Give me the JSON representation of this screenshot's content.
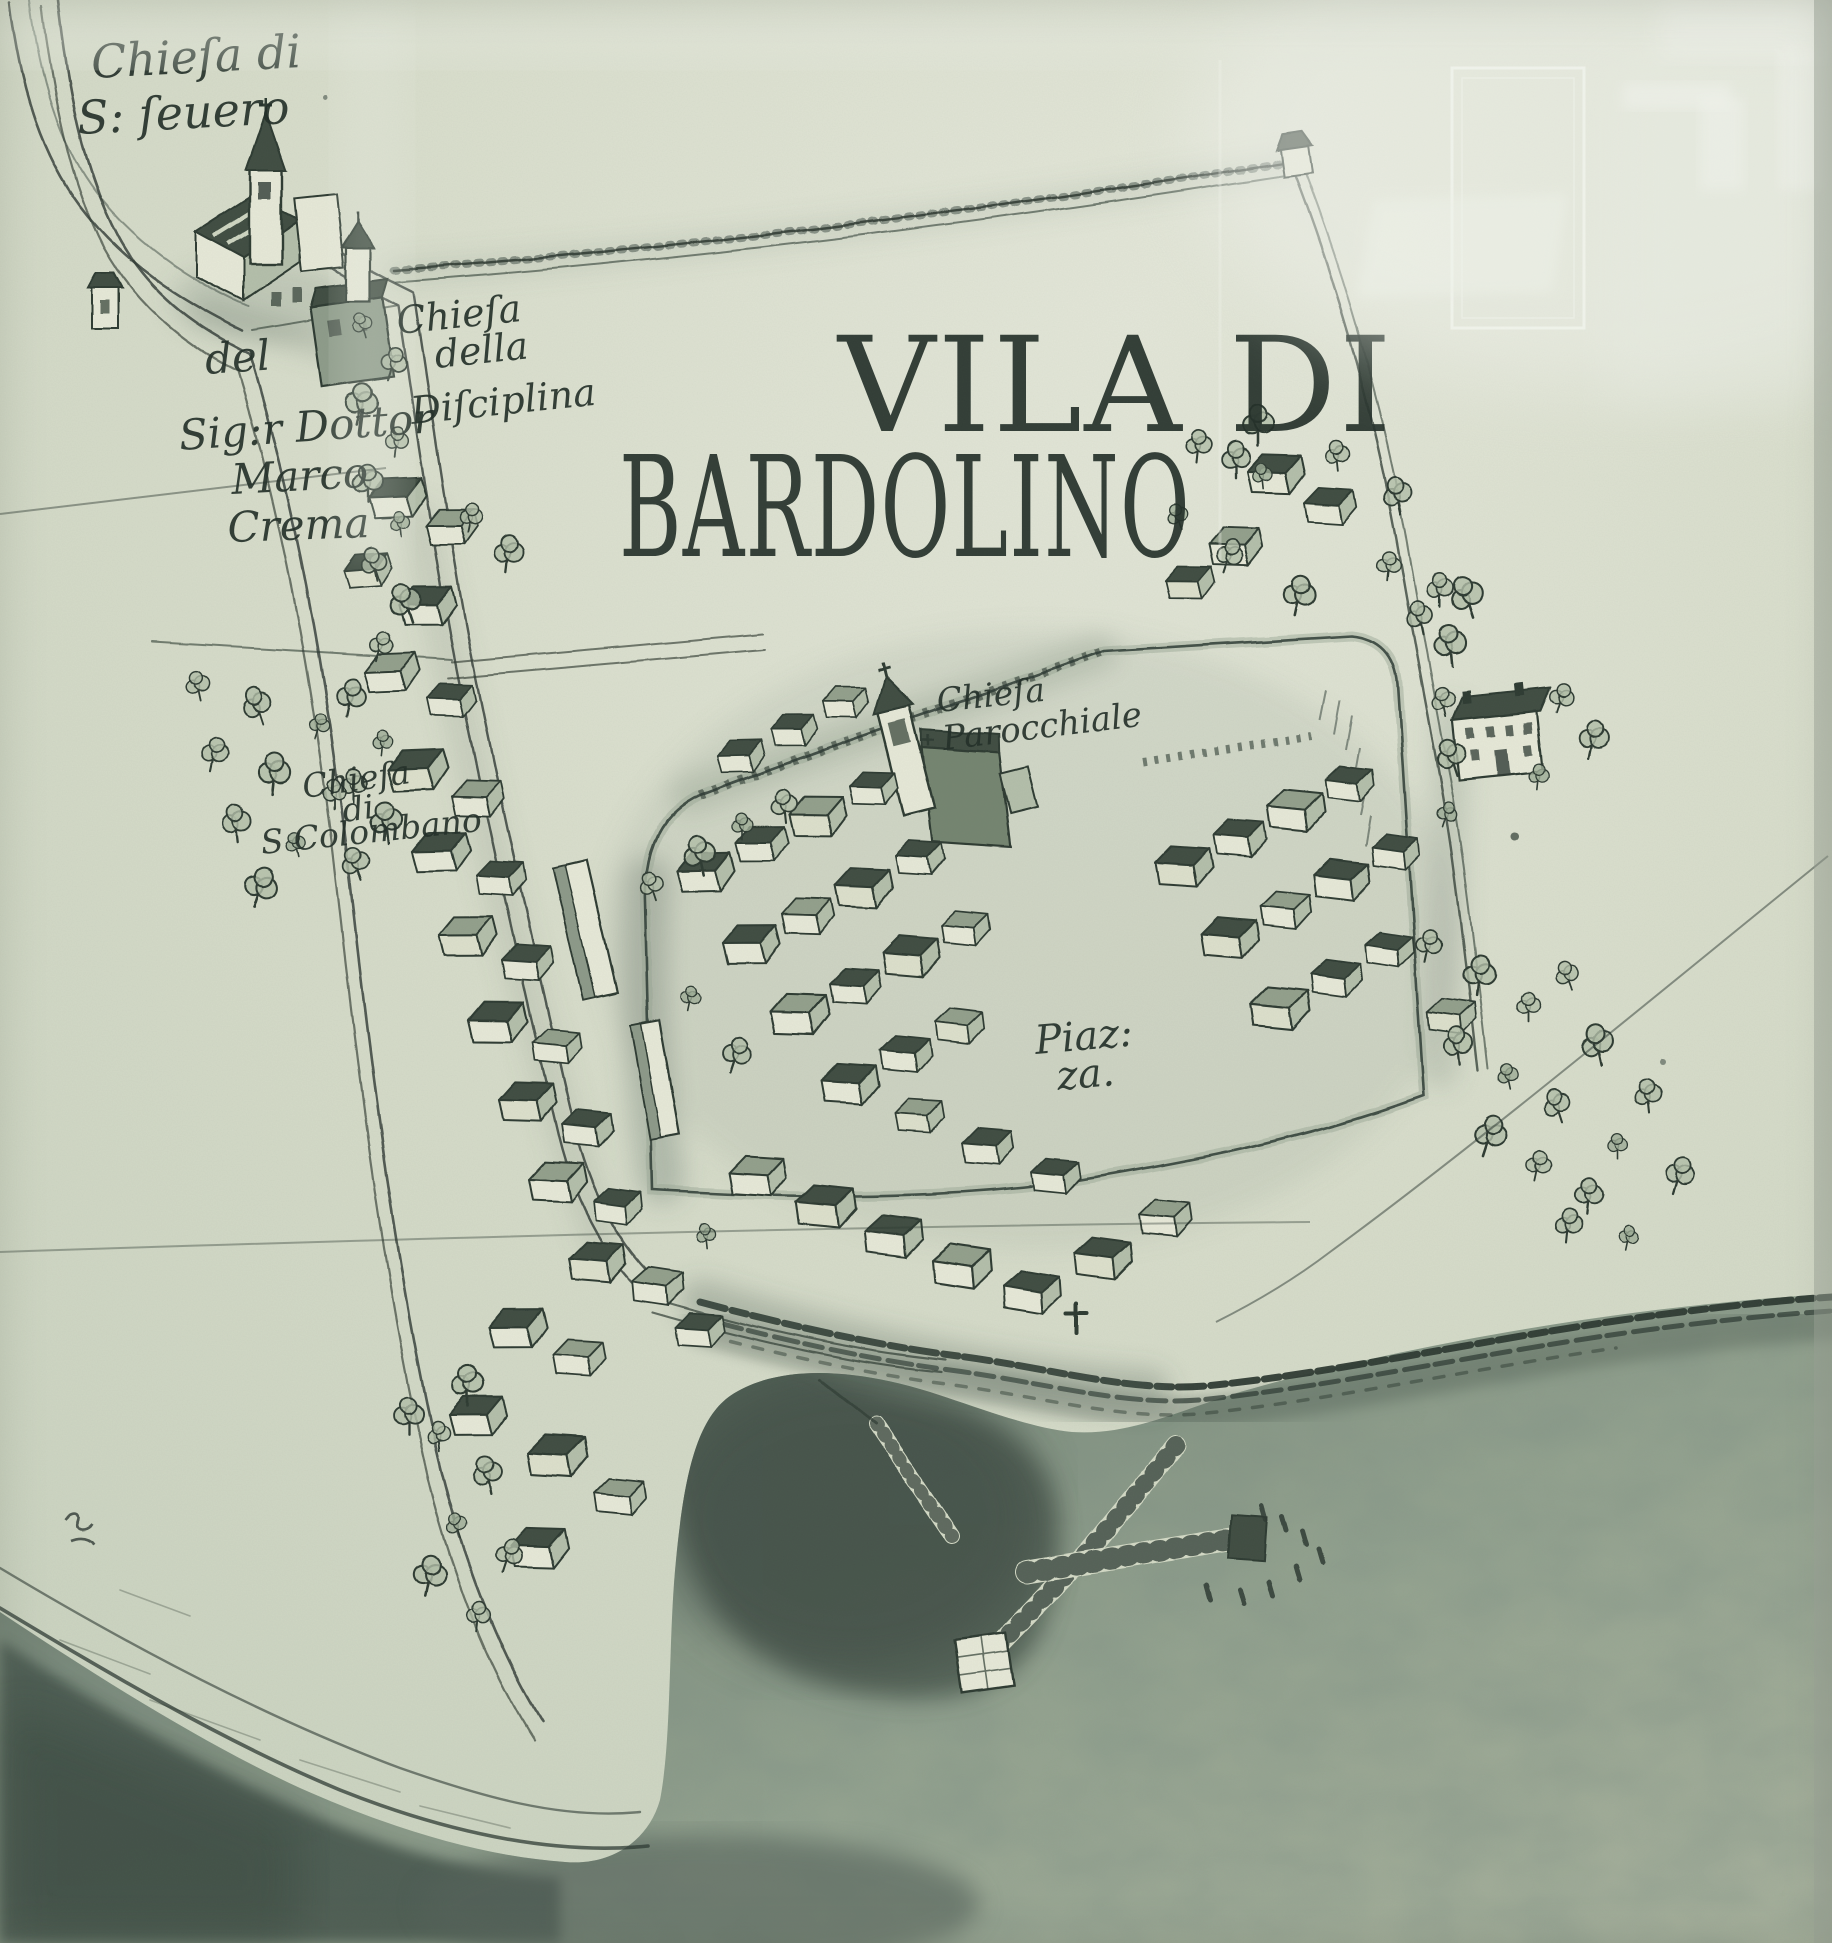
{
  "title": {
    "line1": "VILA DI",
    "line2": "BARDOLINO"
  },
  "labels": {
    "chiesa_s_severo": {
      "line1": "Chieſa di",
      "line2": "S: ſeuero"
    },
    "crema_property": {
      "line1": "del",
      "line2": "Sig:r Dottor",
      "line3": "Marco",
      "line4": "Crema"
    },
    "chiesa_disciplina": {
      "line1": "Chieſa",
      "line2": "della",
      "line3": "Diſciplina"
    },
    "chiesa_parocchiale": {
      "line1": "Chieſa",
      "line2": "Parocchiale"
    },
    "chiesa_s_colombano": {
      "line1": "Chieſa",
      "line2": "di",
      "line3": "S Colombano"
    },
    "piazza": {
      "line1": "Piaz:",
      "line2": "za."
    }
  },
  "colors": {
    "paper": "#d6dbc9",
    "paper_light": "#e4e7d9",
    "paper_dark": "#c6cfbc",
    "ink": "#2e3a33",
    "ink_dark": "#232f29",
    "lake_mid": "#8e9d8d",
    "lake_light": "#a6b09c",
    "lake_dark": "#47554d",
    "wash": "#6a7a6e",
    "roof": "#3f4d43",
    "face": "#e7e9d8",
    "gable": "#b4bfab",
    "canopy": "#b3bfa9",
    "reflection": "#eef0e9"
  }
}
